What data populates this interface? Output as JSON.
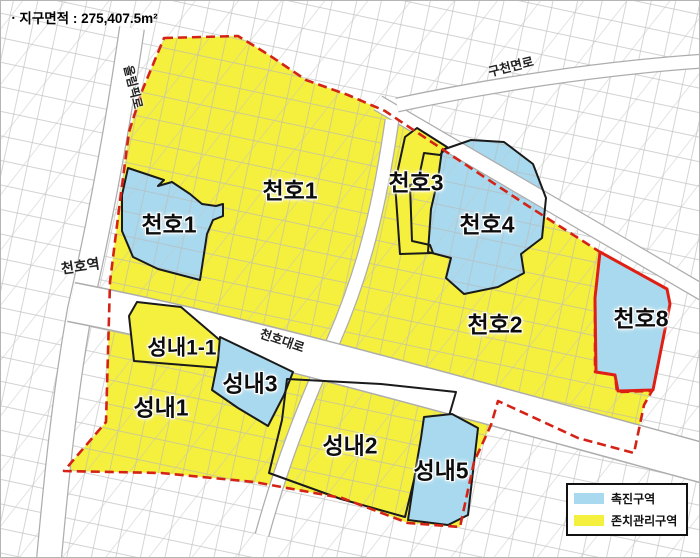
{
  "title": {
    "text": "ㆍ지구면적 : 275,407.5m²"
  },
  "legend": {
    "items": [
      {
        "id": "promotion-zone",
        "label": "촉진구역",
        "color": "#a8d9ee"
      },
      {
        "id": "maintenance-zone",
        "label": "존치관리구역",
        "color": "#f5ef3d"
      }
    ]
  },
  "map_labels": [
    {
      "id": "cheonho1-promotion",
      "text": "천호1"
    },
    {
      "id": "cheonho1",
      "text": "천호1"
    },
    {
      "id": "cheonho3",
      "text": "천호3"
    },
    {
      "id": "cheonho4",
      "text": "천호4"
    },
    {
      "id": "cheonho2",
      "text": "천호2"
    },
    {
      "id": "cheonho8",
      "text": "천호8"
    },
    {
      "id": "seongnae1-1",
      "text": "성내1-1"
    },
    {
      "id": "seongnae3",
      "text": "성내3"
    },
    {
      "id": "seongnae1",
      "text": "성내1"
    },
    {
      "id": "seongnae2",
      "text": "성내2"
    },
    {
      "id": "seongnae5",
      "text": "성내5"
    }
  ],
  "road_labels": [
    {
      "id": "olympic-ro",
      "text": "올림픽로"
    },
    {
      "id": "gucheonmyeon-ro",
      "text": "구천면로"
    },
    {
      "id": "cheonho-daero",
      "text": "천호대로"
    }
  ],
  "station_label": {
    "text": "천호역"
  },
  "colors": {
    "promotion_blue": "#a8d9ee",
    "maintenance_yellow": "#f5ef3d",
    "boundary_red": "#d42316",
    "outline_black": "#1a1a1a"
  }
}
